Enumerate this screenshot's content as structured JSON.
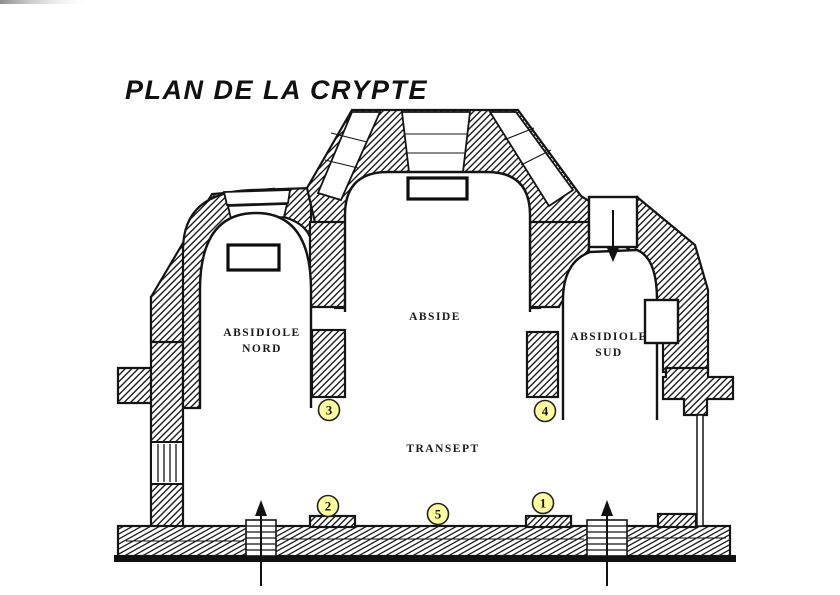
{
  "title": {
    "text": "PLAN DE LA CRYPTE"
  },
  "rooms": {
    "abside": {
      "label": "ABSIDE"
    },
    "absidiole_nord": {
      "line1": "ABSIDIOLE",
      "line2": "NORD"
    },
    "absidiole_sud": {
      "line1": "ABSIDIOLE",
      "line2": "SUD"
    },
    "transept": {
      "label": "TRANSEPT"
    }
  },
  "markers": {
    "m1": {
      "number": "1"
    },
    "m2": {
      "number": "2"
    },
    "m3": {
      "number": "3"
    },
    "m4": {
      "number": "4"
    },
    "m5": {
      "number": "5"
    }
  },
  "colors": {
    "ink": "#141414",
    "marker_fill": "#FFFF9E",
    "background": "#FFFFFF"
  }
}
